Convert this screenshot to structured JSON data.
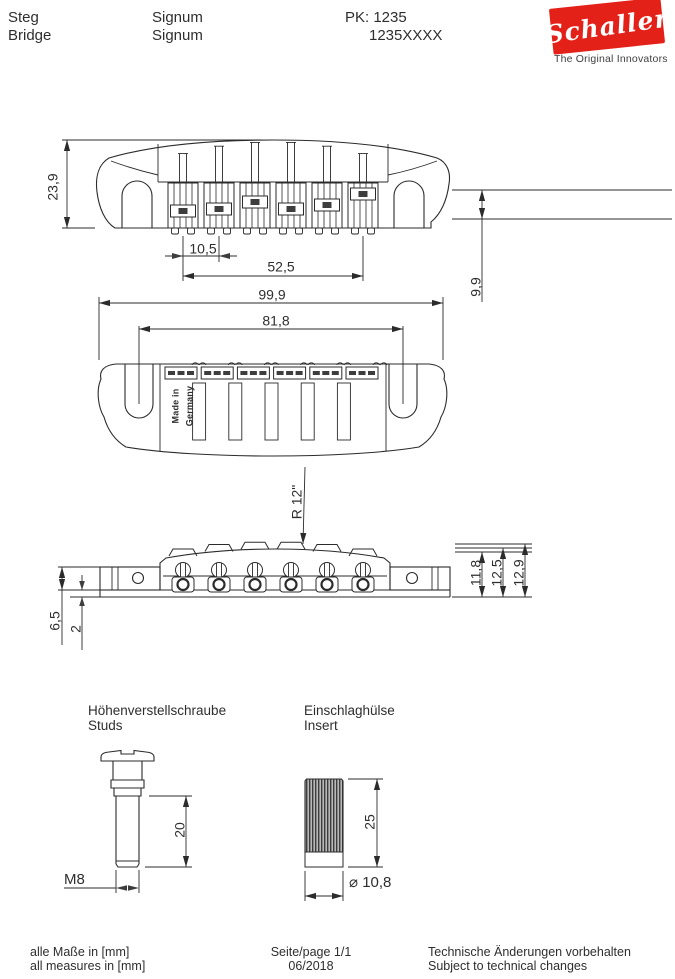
{
  "header": {
    "product_de": "Steg",
    "product_en": "Bridge",
    "model_line1": "Signum",
    "model_line2": "Signum",
    "pk": "PK: 1235",
    "article": "1235XXXX",
    "logo_brand": "Schaller",
    "logo_tagline": "The Original Innovators",
    "logo_color": "#e32119"
  },
  "drawing": {
    "front_view": {
      "height": "23,9",
      "string_spacing": "10,5",
      "e_to_e_spacing": "52,5",
      "right_height": "9,9"
    },
    "top_view": {
      "overall_length": "99,9",
      "stud_spacing": "81,8",
      "made_in_line1": "Made in",
      "made_in_line2": "Germany"
    },
    "side_view": {
      "radius": "R 12\"",
      "height_1": "11,8",
      "height_2": "12,5",
      "height_3": "12,9",
      "tab_height": "6,5",
      "plate_thickness": "2"
    }
  },
  "components": {
    "stud": {
      "label_de": "Höhenverstellschraube",
      "label_en": "Studs",
      "length": "20",
      "thread": "M8"
    },
    "insert": {
      "label_de": "Einschlaghülse",
      "label_en": "Insert",
      "length": "25",
      "diameter": "⌀ 10,8"
    }
  },
  "footer": {
    "units_de": "alle Maße in [mm]",
    "units_en": "all measures in [mm]",
    "page": "Seite/page 1/1",
    "date": "06/2018",
    "notice_de": "Technische Änderungen vorbehalten",
    "notice_en": "Subject to technical changes"
  }
}
